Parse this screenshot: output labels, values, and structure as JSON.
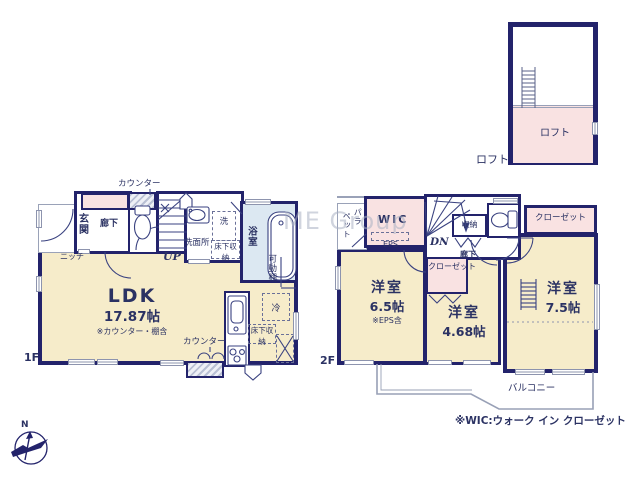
{
  "watermark": "ME Group",
  "compass": {
    "north": "N"
  },
  "floors": {
    "f1": "1F",
    "f2": "2F",
    "loft": "ロフト"
  },
  "note": "※WIC:ウォーク イン クローゼット",
  "loft": {
    "room": "ロフト"
  },
  "f1": {
    "counter_top": "カウンター",
    "genkan": "玄関",
    "rouka": "廊下",
    "niche": "ニッチ",
    "up": "UP",
    "senmenjo": "洗面所",
    "sen": "洗",
    "yukashita_wash": "床下収納",
    "yokushitsu": "浴室",
    "kadoudana": "可動棚",
    "ldk": "LDK",
    "ldk_size": "17.87帖",
    "ldk_note": "※カウンター・棚含",
    "counter_kitchen": "カウンター",
    "rei": "冷",
    "yukashita_kitchen": "床下収納"
  },
  "f2": {
    "parapet_a": "パラ",
    "parapet_b": "ペット",
    "wic": "WIC",
    "eps": "EPS",
    "dn": "DN",
    "shuno": "収納",
    "rouka": "廊下",
    "closet_right": "クローゼット",
    "closet_mid": "クローゼット",
    "room1": "洋室",
    "room1_size": "6.5帖",
    "room1_note": "※EPS含",
    "room2": "洋室",
    "room2_size": "4.68帖",
    "room3": "洋室",
    "room3_size": "7.5帖",
    "balcony": "バルコニー"
  }
}
